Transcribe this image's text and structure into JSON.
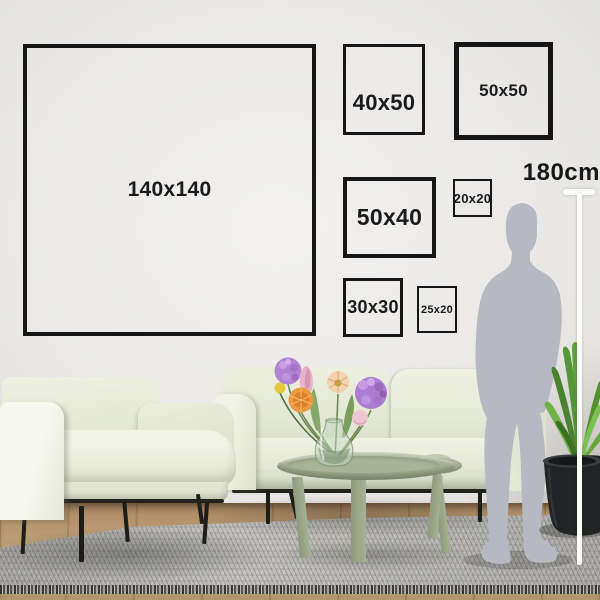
{
  "title": "wall-frame-size-guide",
  "frames": [
    {
      "name": "frame-140x140",
      "label": "140x140"
    },
    {
      "name": "frame-40x50",
      "label": "40x50"
    },
    {
      "name": "frame-50x50",
      "label": "50x50"
    },
    {
      "name": "frame-50x40",
      "label": "50x40"
    },
    {
      "name": "frame-20x20",
      "label": "20x20"
    },
    {
      "name": "frame-30x30",
      "label": "30x30"
    },
    {
      "name": "frame-25x20",
      "label": "25x20"
    }
  ],
  "ruler": {
    "height_label": "180cm"
  },
  "colors": {
    "frame_border": "#161616",
    "label_text": "#1b1b1b",
    "ruler_white": "#fcfcf8",
    "silhouette_gray": "#b6b9c1",
    "sage_green": "#a9b499",
    "rug_gray": "#b5b4b1",
    "wood_tan": "#b2956d"
  },
  "scene": {
    "objects": [
      "armchair",
      "sofa",
      "coffee-table",
      "side-table",
      "vase-with-flowers",
      "potted-plant",
      "human-silhouette",
      "area-rug",
      "wood-floor"
    ]
  }
}
